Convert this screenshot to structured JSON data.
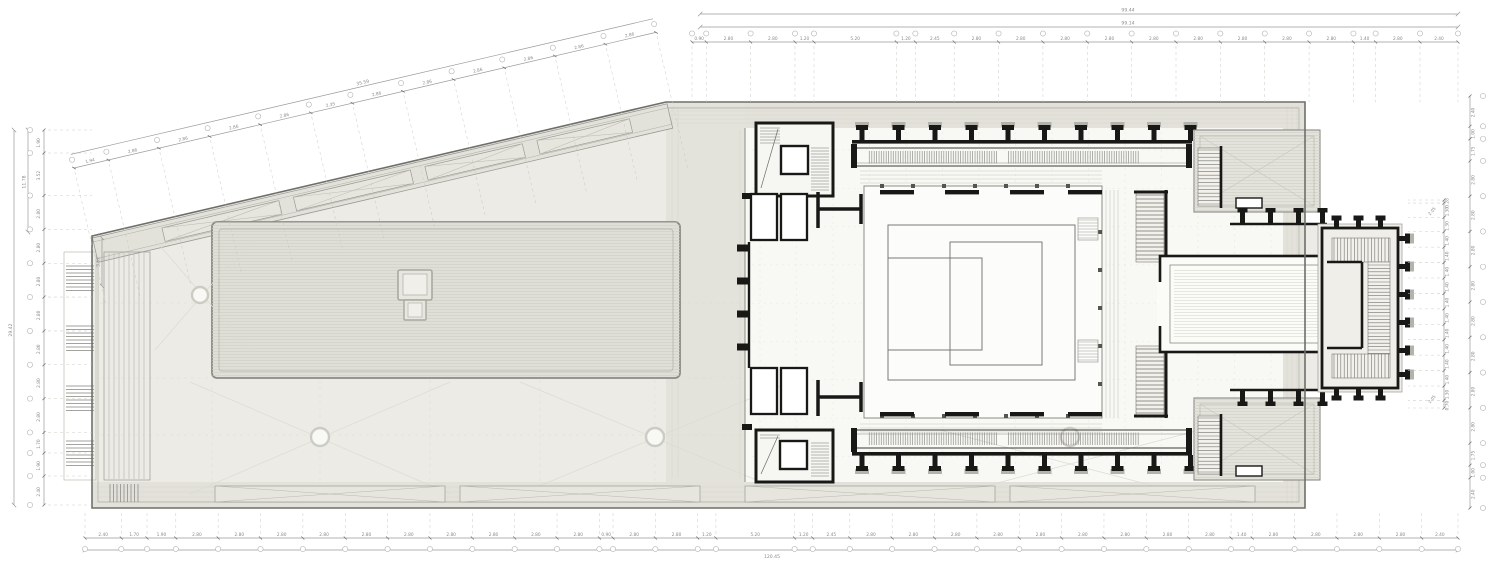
{
  "document": {
    "type": "architectural-floor-plan",
    "description": "CAD roof / upper level plan of an elongated building with angled plaza, central hall, colonnades and monumental entrance stair"
  },
  "colors": {
    "background": "#ffffff",
    "plaza_fill": "#ecebe5",
    "band_fill": "#e3e2da",
    "slab_fill": "#e0dfd7",
    "interior_fill": "#f8f8f4",
    "wall": "#181816",
    "thin_line": "#8b8b85",
    "hatch_line": "#cfcec6",
    "dimension": "#8f8f8d"
  },
  "annotations": {
    "top_totals": {
      "upper": "99.44",
      "lower": "99.14"
    },
    "top_chain": {
      "segments": [
        "0.90",
        "2.80",
        "2.80",
        "1.20",
        "5.20",
        "1.20",
        "2.45",
        "2.80",
        "2.80",
        "2.80",
        "2.80",
        "2.80",
        "2.80",
        "2.80",
        "2.80",
        "2.80",
        "1.40",
        "2.80",
        "2.40"
      ]
    },
    "diagonal_chain": {
      "total": "35.59",
      "segments": [
        "1.94",
        "2.86",
        "2.86",
        "2.86",
        "2.86",
        "2.35",
        "2.86",
        "2.86",
        "2.86",
        "2.86",
        "2.86",
        "2.86"
      ]
    },
    "bottom_chain": {
      "total": "120.45",
      "segments": [
        "2.40",
        "1.70",
        "1.90",
        "2.80",
        "2.80",
        "2.80",
        "2.80",
        "2.80",
        "2.80",
        "2.80",
        "2.80",
        "2.80",
        "2.80",
        "0.90",
        "2.80",
        "2.80",
        "1.20",
        "5.20",
        "1.20",
        "2.45",
        "2.80",
        "2.80",
        "2.80",
        "2.80",
        "2.80",
        "2.80",
        "2.80",
        "2.80",
        "2.80",
        "1.40",
        "2.80",
        "2.80",
        "2.80",
        "2.80",
        "2.40"
      ]
    },
    "left_chain": {
      "total_outer": "29.42",
      "total_upper": "11.78",
      "offset_label": "3.52",
      "segments": [
        "1.90",
        "3.52",
        "2.80",
        "2.80",
        "2.80",
        "2.80",
        "2.80",
        "2.80",
        "2.80",
        "1.70",
        "1.90",
        "2.40"
      ]
    },
    "right_outer_chain": {
      "segments": [
        "2.40",
        "1.00",
        "1.75",
        "2.80",
        "2.80",
        "2.80",
        "2.80",
        "2.80",
        "2.80",
        "2.80",
        "2.80",
        "1.75",
        "1.00",
        "2.40"
      ]
    },
    "right_inner_chain": {
      "segments": [
        "0.28",
        "1.30",
        "1.30",
        "1.40",
        "1.40",
        "1.40",
        "1.40",
        "1.40",
        "1.40",
        "1.40",
        "1.40",
        "1.40",
        "1.40",
        "1.30",
        "0.70"
      ],
      "oblique": [
        "2.05",
        "2.05"
      ]
    }
  }
}
